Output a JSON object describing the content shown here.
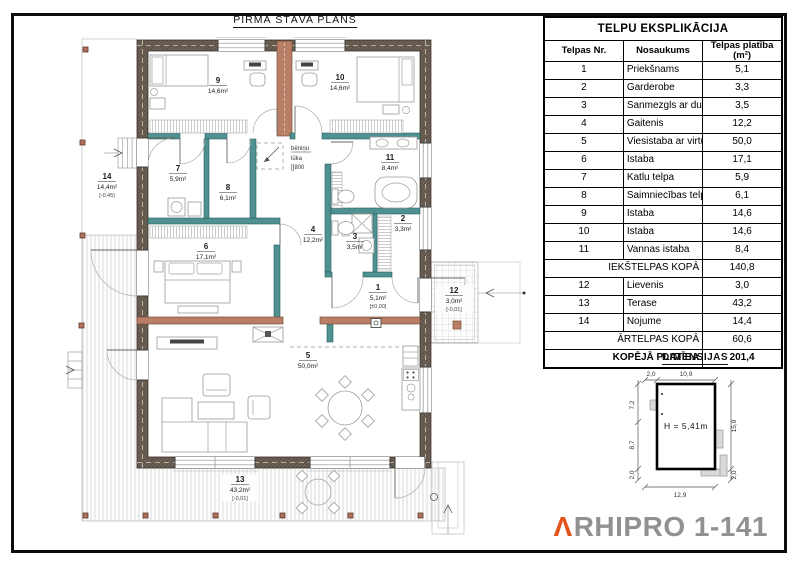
{
  "page": {
    "plan_title": "PIRMĀ STĀVA PLĀNS"
  },
  "plan": {
    "rooms": [
      {
        "num": "1",
        "area": "5,1m²",
        "elev": "[±0,00]"
      },
      {
        "num": "2",
        "area": "3,3m²"
      },
      {
        "num": "3",
        "area": "3,5m²"
      },
      {
        "num": "4",
        "area": "12,2m²"
      },
      {
        "num": "5",
        "area": "50,0m²"
      },
      {
        "num": "6",
        "area": "17,1m²"
      },
      {
        "num": "7",
        "area": "5,9m²"
      },
      {
        "num": "8",
        "area": "6,1m²"
      },
      {
        "num": "9",
        "area": "14,6m²"
      },
      {
        "num": "10",
        "area": "14,6m²"
      },
      {
        "num": "11",
        "area": "8,4m²"
      },
      {
        "num": "12",
        "area": "3,0m²",
        "elev": "[-0,01]"
      },
      {
        "num": "13",
        "area": "43,2m²",
        "elev": "[-0,01]"
      },
      {
        "num": "14",
        "area": "14,4m²",
        "elev": "[-0,45]"
      }
    ],
    "attic": {
      "line1": "bēniņu",
      "line2": "lūka",
      "line3": "[]800"
    }
  },
  "table": {
    "title": "TELPU EKSPLIKĀCIJA",
    "col_nr": "Telpas Nr.",
    "col_name": "Nosaukums",
    "col_area": "Telpas platība (m²)",
    "rows": [
      {
        "nr": "1",
        "name": "Priekšnams",
        "area": "5,1"
      },
      {
        "nr": "2",
        "name": "Garderobe",
        "area": "3,3"
      },
      {
        "nr": "3",
        "name": "Sanmezgls ar dušu",
        "area": "3,5"
      },
      {
        "nr": "4",
        "name": "Gaitenis",
        "area": "12,2"
      },
      {
        "nr": "5",
        "name": "Viesistaba ar virtuvi",
        "area": "50,0"
      },
      {
        "nr": "6",
        "name": "Istaba",
        "area": "17,1"
      },
      {
        "nr": "7",
        "name": "Katlu telpa",
        "area": "5,9"
      },
      {
        "nr": "8",
        "name": "Saimniecības telpa",
        "area": "6,1"
      },
      {
        "nr": "9",
        "name": "Istaba",
        "area": "14,6"
      },
      {
        "nr": "10",
        "name": "Istaba",
        "area": "14,6"
      },
      {
        "nr": "11",
        "name": "Vannas istaba",
        "area": "8,4"
      },
      {
        "nr": "12",
        "name": "Lievenis",
        "area": "3,0"
      },
      {
        "nr": "13",
        "name": "Terase",
        "area": "43,2"
      },
      {
        "nr": "14",
        "name": "Nojume",
        "area": "14,4"
      }
    ],
    "subtotal_inner": {
      "label": "IEKŠTELPAS KOPĀ",
      "value": "140,8"
    },
    "subtotal_outer": {
      "label": "ĀRTELPAS KOPĀ",
      "value": "60,6"
    },
    "total": {
      "label": "KOPĒJĀ PLATĪBA",
      "value": "201,4"
    }
  },
  "dimensions": {
    "title": "DIMENSIJAS",
    "height_label": "H = 5,41m",
    "top_left": "2,0",
    "top": "10,9",
    "left_upper": "7,2",
    "left_lower": "8,7",
    "left_bottom": "2,0",
    "right": "15,9",
    "right_bottom": "2,0",
    "bottom": "12,9"
  },
  "logo": {
    "mark": "Λ",
    "name": "RHIPRO 1-141"
  },
  "colors": {
    "accent_orange": "#e5531d",
    "wall_exterior": "#6d6054",
    "wall_partition_teal": "#4f9191",
    "wall_interior_salmon": "#b97f66"
  }
}
